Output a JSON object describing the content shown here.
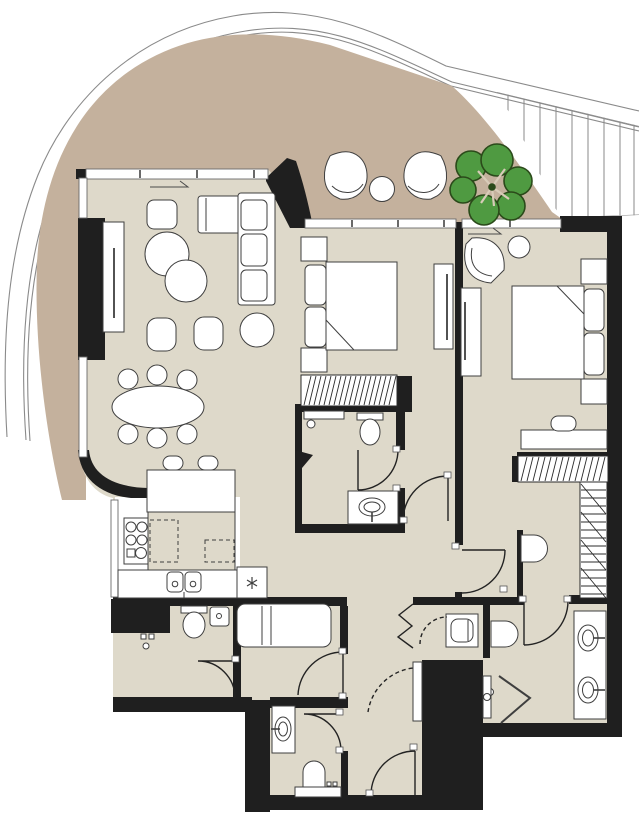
{
  "meta": {
    "artifact": "residential-apartment-floor-plan",
    "view": "top-down architectural drawing",
    "visible_text_labels": []
  },
  "colors": {
    "background": "#ffffff",
    "terrace": "#c4b19d",
    "floor": "#ded9ca",
    "kitchen_floor": "#ffffff",
    "wall": "#1f1f1f",
    "line": "#3f3f3f",
    "furn": "#ffffff",
    "tree": "#4f9a41",
    "treeline": "#2b4a1a",
    "hatch": "#2b2b2b",
    "boundary": "#8a8a8a",
    "counter": "#ded9ca"
  },
  "site": {
    "elements": [
      "curved-street-boundary",
      "neighbor-louvre-stripes"
    ]
  },
  "terrace": {
    "name": "wrap-around-terrace",
    "furniture": [
      "lounge-chair",
      "lounge-chair",
      "round-side-table",
      "tree-canopy"
    ]
  },
  "rooms": [
    {
      "name": "living-dining-room",
      "furniture": [
        "sectional-sofa",
        "chaise-ottoman",
        "armchair",
        "round-coffee-table",
        "round-coffee-table",
        "pouf",
        "pouf",
        "round-pouf",
        "oval-dining-table",
        "dining-chairs-x6",
        "tv-console"
      ]
    },
    {
      "name": "kitchen",
      "furniture": [
        "island-counter",
        "bar-stools-x2",
        "cooktop",
        "dashed-upper-cabinets",
        "double-sink",
        "refrigerator-snowflake"
      ]
    },
    {
      "name": "bedroom-2",
      "furniture": [
        "double-bed",
        "pillows-x2",
        "nightstands-x2",
        "tv-dresser",
        "built-in-wardrobe-hatch"
      ]
    },
    {
      "name": "bedroom-2-ensuite-bathroom",
      "furniture": [
        "shower",
        "toilet",
        "vanity-basin"
      ]
    },
    {
      "name": "master-bedroom",
      "furniture": [
        "double-bed",
        "pillows-x2",
        "nightstands-x2",
        "tv-dresser",
        "fan-lounge-chair",
        "round-side-table",
        "desk",
        "desk-chair"
      ]
    },
    {
      "name": "walk-in-closet",
      "furniture": [
        "wardrobe-rail-hatch",
        "wardrobe-rail-hatch"
      ]
    },
    {
      "name": "master-bathroom",
      "furniture": [
        "double-vanity",
        "wall-hung-toilet",
        "corner-shower"
      ]
    },
    {
      "name": "powder-room",
      "furniture": [
        "vanity-basin",
        "toilet",
        "ledge"
      ]
    },
    {
      "name": "utility-wc",
      "furniture": [
        "duct-shaft",
        "toilet",
        "hand-basin",
        "taps"
      ]
    },
    {
      "name": "bedroom-3",
      "furniture": [
        "single-daybed"
      ]
    },
    {
      "name": "laundry-niche",
      "furniture": [
        "washing-machine",
        "folding-door",
        "pivot-door"
      ]
    },
    {
      "name": "hallway",
      "furniture": [
        "towel-radiator",
        "wall-basin"
      ]
    }
  ],
  "openings": {
    "hinged_doors": 8,
    "dashed_swing_doors": 2,
    "folding_doors": 1,
    "window_bands": 6,
    "sliding_direction_arrows": 2
  }
}
